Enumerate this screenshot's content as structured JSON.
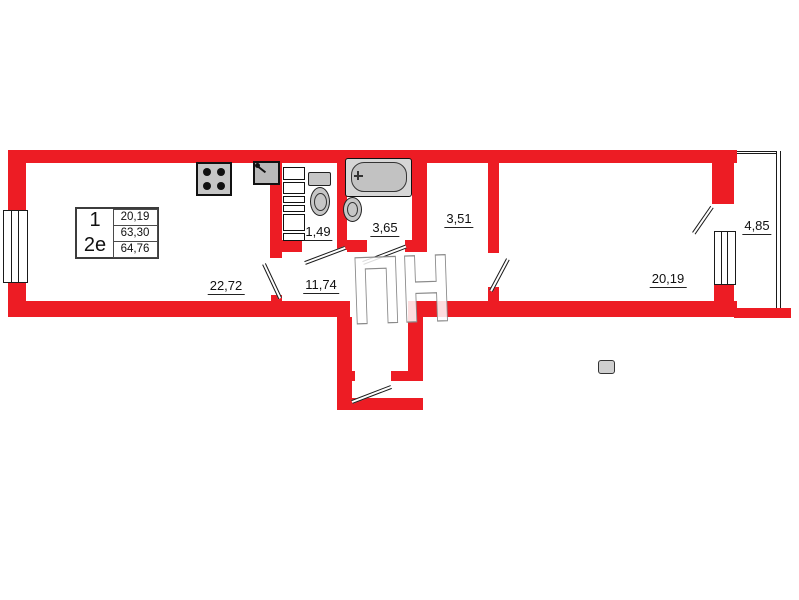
{
  "colors": {
    "wall_red": "#ed1c24",
    "line_black": "#1a1a1a",
    "fixture_gray": "#c6c6c6",
    "watermark_gray": "#8a8a8a"
  },
  "info_box": {
    "rooms_count": "1",
    "flat_type": "2е",
    "area_living": "20,19",
    "area_flat": "63,30",
    "area_total": "64,76"
  },
  "rooms": {
    "kitchen_living": "22,72",
    "hallway": "11,74",
    "wc": "1,49",
    "bathroom": "3,65",
    "corridor": "3,51",
    "bedroom": "20,19",
    "balcony": "4,85"
  },
  "watermark": "ПН",
  "icons": {
    "stove": "stove-icon",
    "kitchen_sink": "kitchen-sink-icon",
    "shaft": "shaft-ladder-icon",
    "toilet": "toilet-icon",
    "bathtub": "bathtub-icon",
    "washbasin": "washbasin-icon",
    "window": "window-icon",
    "door": "door-leaf-icon"
  }
}
